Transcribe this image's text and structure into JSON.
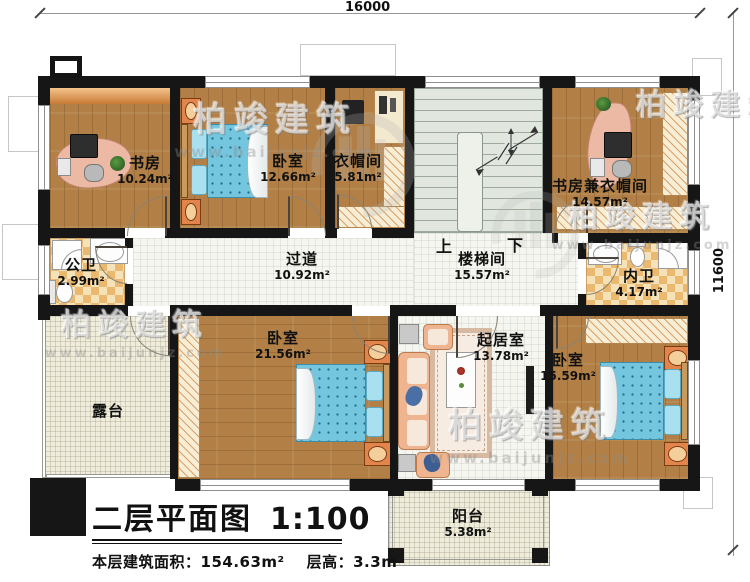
{
  "dimensions": {
    "top": "16000",
    "right": "11600"
  },
  "stair_labels": {
    "up": "上",
    "down": "下"
  },
  "rooms": {
    "study": {
      "name": "书房",
      "area": "10.24m²"
    },
    "bedroom1": {
      "name": "卧室",
      "area": "12.66m²"
    },
    "cloakroom": {
      "name": "衣帽间",
      "area": "5.81m²"
    },
    "study_cloak": {
      "name": "书房兼衣帽间",
      "area": "14.57m²"
    },
    "public_bath": {
      "name": "公卫",
      "area": "2.99m²"
    },
    "hallway": {
      "name": "过道",
      "area": "10.92m²"
    },
    "stairwell": {
      "name": "楼梯间",
      "area": "15.57m²"
    },
    "ensuite_bath": {
      "name": "内卫",
      "area": "4.17m²"
    },
    "terrace": {
      "name": "露台"
    },
    "bedroom2": {
      "name": "卧室",
      "area": "21.56m²"
    },
    "living": {
      "name": "起居室",
      "area": "13.78m²"
    },
    "bedroom3": {
      "name": "卧室",
      "area": "15.59m²"
    },
    "balcony": {
      "name": "阳台",
      "area": "5.38m²"
    }
  },
  "title": {
    "main": "二层平面图",
    "scale": "1:100",
    "area_label": "本层建筑面积：",
    "area_value": "154.63m²",
    "height_label": "层高：",
    "height_value": "3.3m"
  },
  "watermark": {
    "brand": "柏竣建筑",
    "url": "www.baijunjz.com"
  },
  "colors": {
    "wall": "#161616",
    "wood_floor": "#b28046",
    "tile_base": "#f6e2b8",
    "tile_check": "#eab96f",
    "bed_blue": "#74c6df",
    "stair_floor": "#e1e7df",
    "terrace_floor": "#efecdb",
    "hall_floor": "#f6f6f0",
    "accent_orange": "#e2854c",
    "desk_pink": "#ecb9a4",
    "sofa_peach": "#efb490"
  }
}
